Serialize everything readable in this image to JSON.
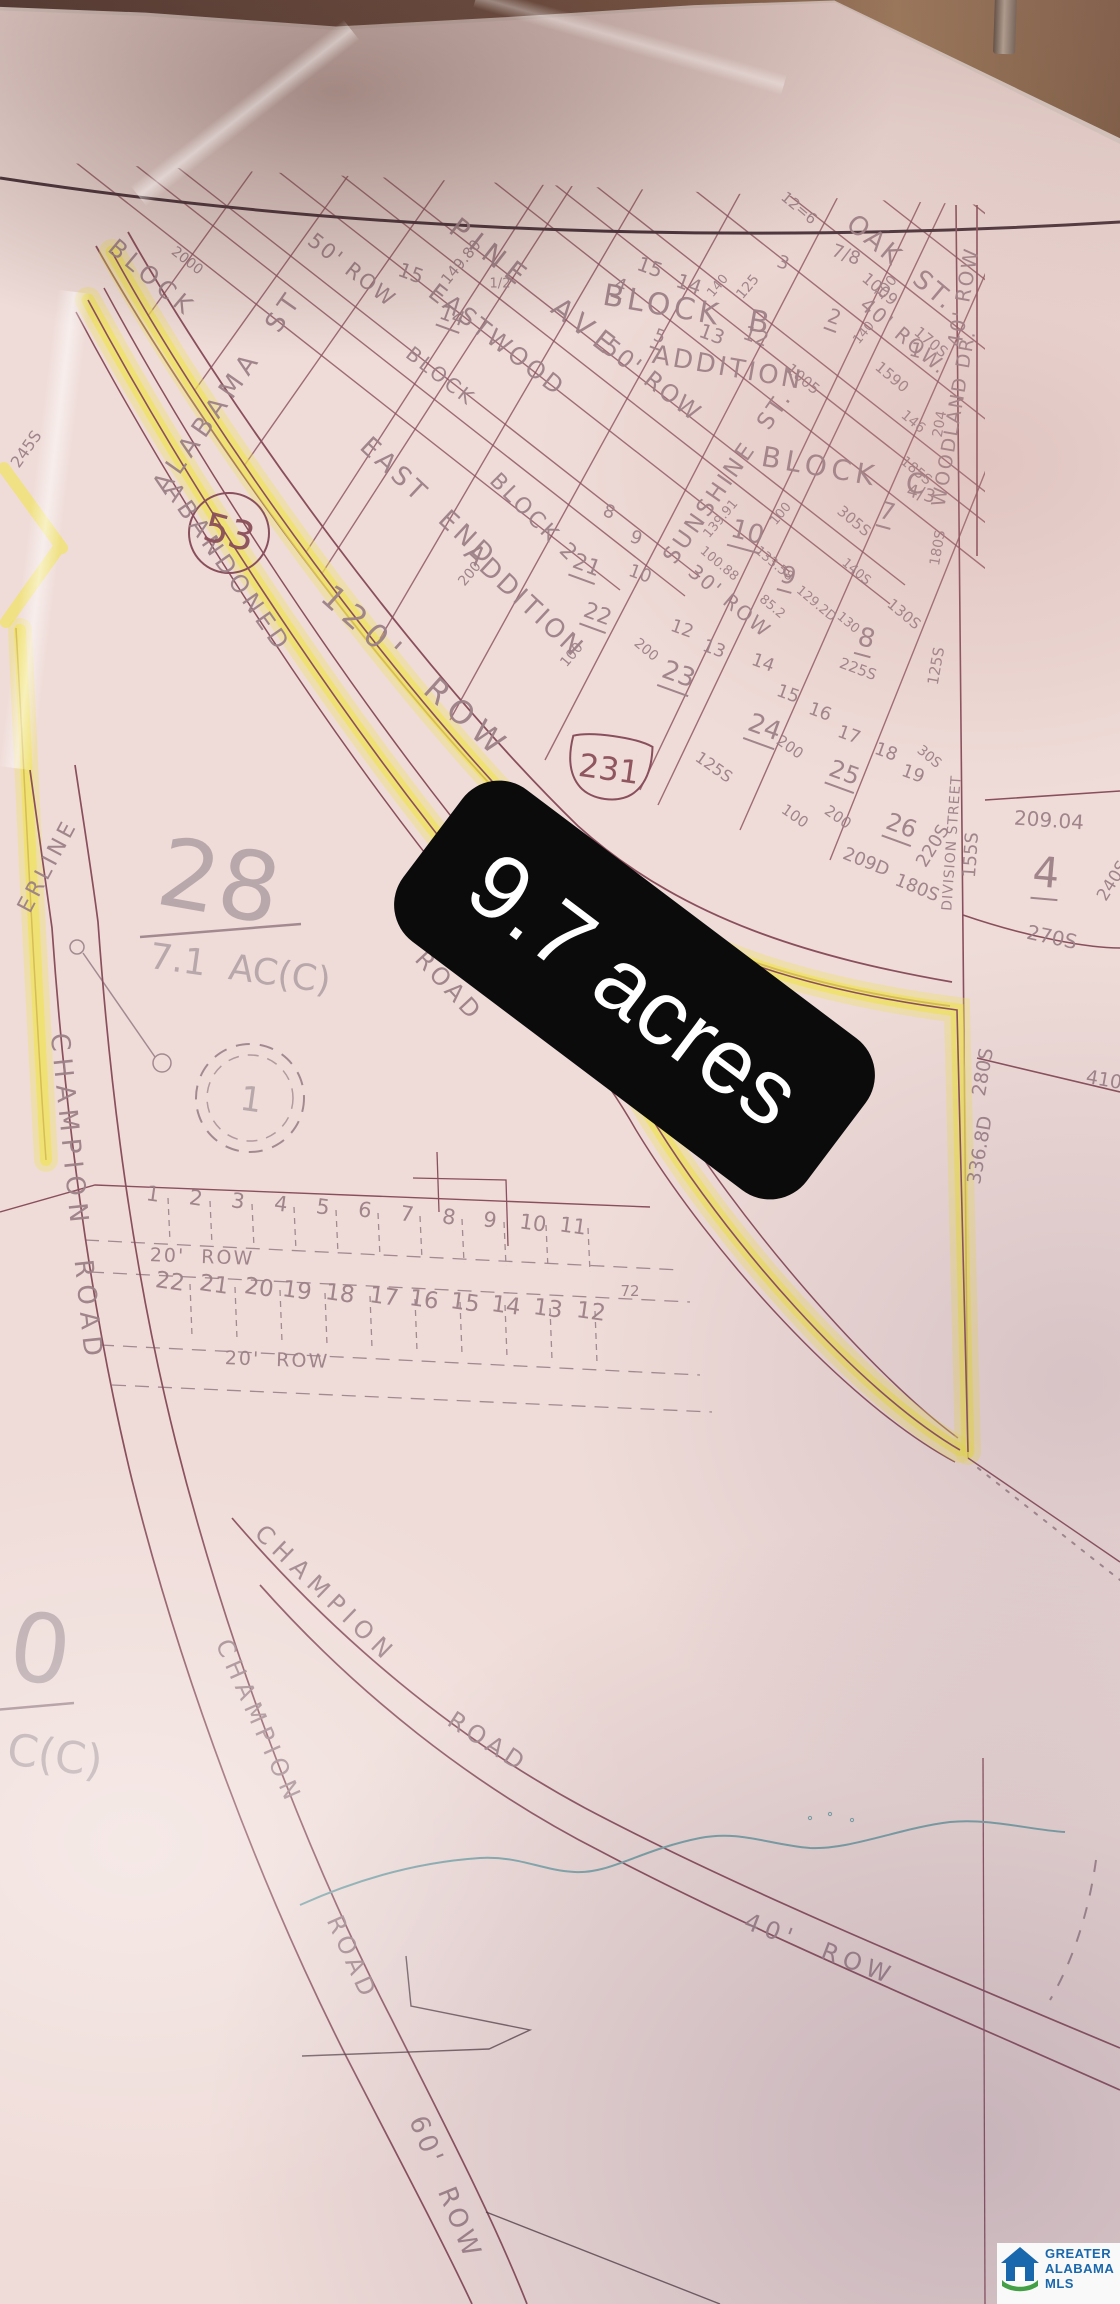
{
  "photo": {
    "acres_label": "9.7 acres"
  },
  "watermark": {
    "line1": "GREATER",
    "line2": "ALABAMA",
    "line3": "MLS"
  },
  "colors": {
    "highlight": "#f0e353",
    "label_bg": "#0b0b0b",
    "label_text": "#ffffff",
    "logo_blue": "#1967ad",
    "logo_green": "#43a047",
    "ink": "#8a4f5c",
    "ink_dark": "#46313a",
    "pencil": "#a38a90",
    "stream": "#7aa4a8"
  },
  "map": {
    "route_shields": [
      {
        "type": "circle",
        "number": "53"
      },
      {
        "type": "us-shield",
        "number": "231"
      }
    ],
    "labels": [
      {
        "t": "BLOCK",
        "x": 152,
        "y": 278,
        "r": 40,
        "s": 24,
        "ls": 5
      },
      {
        "t": "PINE  AVE",
        "x": 535,
        "y": 288,
        "r": 38,
        "s": 28,
        "ls": 8
      },
      {
        "t": "ALABAMA  ST",
        "x": 228,
        "y": 392,
        "r": -55,
        "s": 26,
        "ls": 6
      },
      {
        "t": "50' ROW",
        "x": 352,
        "y": 270,
        "r": 38,
        "s": 21,
        "ls": 2
      },
      {
        "t": "EASTWOOD",
        "x": 497,
        "y": 340,
        "r": 38,
        "s": 24,
        "ls": 3
      },
      {
        "t": "BLOCK",
        "x": 441,
        "y": 376,
        "r": 38,
        "s": 20,
        "ls": 3
      },
      {
        "t": "BLOCK  B",
        "x": 688,
        "y": 310,
        "r": 10,
        "s": 30,
        "ls": 4
      },
      {
        "t": "ADDITION",
        "x": 728,
        "y": 368,
        "r": 10,
        "s": 26,
        "ls": 3
      },
      {
        "t": "50' ROW",
        "x": 652,
        "y": 380,
        "r": 38,
        "s": 24,
        "ls": 2
      },
      {
        "t": "OAK  ST.",
        "x": 901,
        "y": 263,
        "r": 40,
        "s": 26,
        "ls": 3
      },
      {
        "t": "40' ROW.",
        "x": 904,
        "y": 336,
        "r": 40,
        "s": 20,
        "ls": 2
      },
      {
        "t": "40' ROW",
        "x": 963,
        "y": 297,
        "r": -80,
        "s": 20,
        "ls": 2
      },
      {
        "t": "WOODLAND DR.",
        "x": 954,
        "y": 418,
        "r": -80,
        "s": 19,
        "ls": 2
      },
      {
        "t": "SUNSHINE  ST.",
        "x": 728,
        "y": 477,
        "r": -55,
        "s": 23,
        "ls": 3
      },
      {
        "t": "BLOCK  C",
        "x": 846,
        "y": 471,
        "r": 10,
        "s": 28,
        "ls": 5
      },
      {
        "t": "EAST  END",
        "x": 428,
        "y": 502,
        "r": 43,
        "s": 26,
        "ls": 4
      },
      {
        "t": "ADDITION",
        "x": 524,
        "y": 601,
        "r": 43,
        "s": 26,
        "ls": 3
      },
      {
        "t": "BLOCK 2",
        "x": 534,
        "y": 518,
        "r": 45,
        "s": 22,
        "ls": 3
      },
      {
        "t": "ABANDONED",
        "x": 228,
        "y": 568,
        "r": 55,
        "s": 24,
        "ls": 5
      },
      {
        "t": "ROAD",
        "x": 449,
        "y": 986,
        "r": 47,
        "s": 24,
        "ls": 4
      },
      {
        "t": "120'  ROW",
        "x": 416,
        "y": 672,
        "r": 42,
        "s": 32,
        "ls": 8
      },
      {
        "t": "DIVISION STREET",
        "x": 952,
        "y": 843,
        "r": -86,
        "s": 14,
        "ls": 1
      },
      {
        "t": "CHAMPION  ROAD",
        "x": 76,
        "y": 1198,
        "r": 84,
        "s": 26,
        "ls": 7
      },
      {
        "t": "CHAMPION",
        "x": 326,
        "y": 1594,
        "r": 44,
        "s": 24,
        "ls": 7
      },
      {
        "t": "ROAD",
        "x": 488,
        "y": 1742,
        "r": 33,
        "s": 24,
        "ls": 5
      },
      {
        "t": "CHAMPION",
        "x": 259,
        "y": 1722,
        "r": 66,
        "s": 24,
        "ls": 6
      },
      {
        "t": "ROAD",
        "x": 352,
        "y": 1958,
        "r": 66,
        "s": 24,
        "ls": 5
      },
      {
        "t": "60'  ROW",
        "x": 445,
        "y": 2188,
        "r": 68,
        "s": 26,
        "ls": 4
      },
      {
        "t": "40'  ROW",
        "x": 820,
        "y": 1949,
        "r": 21,
        "s": 24,
        "ls": 6
      },
      {
        "t": "ERLINE",
        "x": 48,
        "y": 866,
        "r": -62,
        "s": 22,
        "ls": 4
      },
      {
        "t": "28",
        "x": 219,
        "y": 882,
        "r": 10,
        "s": 95,
        "c": "f"
      },
      {
        "t": "7.1  AC(C)",
        "x": 240,
        "y": 969,
        "r": 8,
        "s": 36,
        "c": "f"
      },
      {
        "t": "0",
        "x": 40,
        "y": 1650,
        "r": 8,
        "s": 95,
        "c": "f"
      },
      {
        "t": "C(C)",
        "x": 55,
        "y": 1756,
        "r": 8,
        "s": 44,
        "c": "f"
      },
      {
        "t": "1",
        "x": 251,
        "y": 1100,
        "r": 8,
        "s": 34,
        "c": "f"
      },
      {
        "t": "4",
        "x": 1046,
        "y": 874,
        "r": 5,
        "s": 42,
        "u": 1
      },
      {
        "t": "53",
        "x": 229,
        "y": 533,
        "r": 15,
        "s": 40,
        "c": "m"
      },
      {
        "t": "231",
        "x": 609,
        "y": 769,
        "r": 8,
        "s": 32,
        "c": "m"
      },
      {
        "t": "15",
        "x": 411,
        "y": 273,
        "r": 20,
        "s": 20
      },
      {
        "t": "14",
        "x": 452,
        "y": 317,
        "r": 20,
        "s": 20,
        "u": 1
      },
      {
        "t": "149.80",
        "x": 461,
        "y": 262,
        "r": -50,
        "s": 15
      },
      {
        "t": "2000",
        "x": 187,
        "y": 261,
        "r": 38,
        "s": 14
      },
      {
        "t": "15",
        "x": 650,
        "y": 267,
        "r": 20,
        "s": 20
      },
      {
        "t": "14",
        "x": 689,
        "y": 284,
        "r": 20,
        "s": 20
      },
      {
        "t": "13",
        "x": 712,
        "y": 334,
        "r": 20,
        "s": 20
      },
      {
        "t": "12",
        "x": 756,
        "y": 336,
        "r": 20,
        "s": 20
      },
      {
        "t": "4",
        "x": 620,
        "y": 287,
        "r": 20,
        "s": 18,
        "u": 1
      },
      {
        "t": "5",
        "x": 659,
        "y": 338,
        "r": 20,
        "s": 18,
        "u": 1
      },
      {
        "t": "3",
        "x": 783,
        "y": 263,
        "r": 20,
        "s": 18
      },
      {
        "t": "2",
        "x": 834,
        "y": 318,
        "r": 20,
        "s": 20,
        "u": 1
      },
      {
        "t": "7/8",
        "x": 846,
        "y": 255,
        "r": 20,
        "s": 18
      },
      {
        "t": "1009",
        "x": 880,
        "y": 289,
        "r": 40,
        "s": 16
      },
      {
        "t": "1005",
        "x": 803,
        "y": 379,
        "r": 40,
        "s": 15
      },
      {
        "t": "125",
        "x": 748,
        "y": 287,
        "r": -50,
        "s": 14
      },
      {
        "t": "140",
        "x": 718,
        "y": 286,
        "r": -50,
        "s": 13
      },
      {
        "t": "100",
        "x": 886,
        "y": 288,
        "r": -50,
        "s": 14
      },
      {
        "t": "140",
        "x": 864,
        "y": 333,
        "r": -50,
        "s": 13
      },
      {
        "t": "12=6",
        "x": 799,
        "y": 208,
        "r": 40,
        "s": 15
      },
      {
        "t": "1/2",
        "x": 500,
        "y": 284,
        "r": 0,
        "s": 13
      },
      {
        "t": "8",
        "x": 609,
        "y": 512,
        "r": 20,
        "s": 18
      },
      {
        "t": "9",
        "x": 636,
        "y": 538,
        "r": 20,
        "s": 18
      },
      {
        "t": "10",
        "x": 640,
        "y": 574,
        "r": 20,
        "s": 18
      },
      {
        "t": "21",
        "x": 586,
        "y": 567,
        "r": 20,
        "s": 22,
        "u": 1
      },
      {
        "t": "22",
        "x": 597,
        "y": 616,
        "r": 20,
        "s": 22,
        "u": 1
      },
      {
        "t": "23",
        "x": 678,
        "y": 676,
        "r": 20,
        "s": 26,
        "u": 1
      },
      {
        "t": "24",
        "x": 764,
        "y": 729,
        "r": 20,
        "s": 26,
        "u": 1
      },
      {
        "t": "25",
        "x": 844,
        "y": 774,
        "r": 20,
        "s": 24,
        "u": 1
      },
      {
        "t": "26",
        "x": 901,
        "y": 827,
        "r": 20,
        "s": 24,
        "u": 1
      },
      {
        "t": "12",
        "x": 682,
        "y": 629,
        "r": 20,
        "s": 18
      },
      {
        "t": "13",
        "x": 714,
        "y": 649,
        "r": 20,
        "s": 18
      },
      {
        "t": "14",
        "x": 763,
        "y": 663,
        "r": 20,
        "s": 18
      },
      {
        "t": "15",
        "x": 788,
        "y": 694,
        "r": 20,
        "s": 18
      },
      {
        "t": "16",
        "x": 820,
        "y": 712,
        "r": 20,
        "s": 18
      },
      {
        "t": "17",
        "x": 849,
        "y": 735,
        "r": 20,
        "s": 18
      },
      {
        "t": "18",
        "x": 886,
        "y": 752,
        "r": 20,
        "s": 18
      },
      {
        "t": "19",
        "x": 913,
        "y": 774,
        "r": 20,
        "s": 18
      },
      {
        "t": "10",
        "x": 747,
        "y": 534,
        "r": 15,
        "s": 26,
        "u": 1
      },
      {
        "t": "9",
        "x": 788,
        "y": 577,
        "r": 15,
        "s": 24,
        "u": 1
      },
      {
        "t": "8",
        "x": 866,
        "y": 640,
        "r": 15,
        "s": 26,
        "u": 1
      },
      {
        "t": "7",
        "x": 887,
        "y": 513,
        "r": 15,
        "s": 24,
        "u": 1
      },
      {
        "t": "4/3",
        "x": 921,
        "y": 494,
        "r": 15,
        "s": 18
      },
      {
        "t": "1",
        "x": 916,
        "y": 350,
        "r": 15,
        "s": 20
      },
      {
        "t": "1590",
        "x": 892,
        "y": 377,
        "r": 40,
        "s": 15
      },
      {
        "t": "170S",
        "x": 931,
        "y": 342,
        "r": 40,
        "s": 15
      },
      {
        "t": "146",
        "x": 913,
        "y": 422,
        "r": 40,
        "s": 14
      },
      {
        "t": "204",
        "x": 940,
        "y": 424,
        "r": -80,
        "s": 14
      },
      {
        "t": "185S",
        "x": 916,
        "y": 471,
        "r": 40,
        "s": 14
      },
      {
        "t": "305S",
        "x": 854,
        "y": 521,
        "r": 40,
        "s": 15
      },
      {
        "t": "139.91",
        "x": 721,
        "y": 519,
        "r": -50,
        "s": 13
      },
      {
        "t": "100",
        "x": 781,
        "y": 514,
        "r": -50,
        "s": 13
      },
      {
        "t": "133.58",
        "x": 774,
        "y": 564,
        "r": 40,
        "s": 13
      },
      {
        "t": "100.88",
        "x": 719,
        "y": 564,
        "r": 40,
        "s": 13
      },
      {
        "t": "85.2",
        "x": 772,
        "y": 607,
        "r": 40,
        "s": 13
      },
      {
        "t": "129.2D",
        "x": 816,
        "y": 604,
        "r": 40,
        "s": 13
      },
      {
        "t": "130",
        "x": 848,
        "y": 623,
        "r": 40,
        "s": 13
      },
      {
        "t": "140S",
        "x": 856,
        "y": 572,
        "r": 40,
        "s": 13
      },
      {
        "t": "130S",
        "x": 904,
        "y": 614,
        "r": 40,
        "s": 15
      },
      {
        "t": "225S",
        "x": 858,
        "y": 669,
        "r": 20,
        "s": 15
      },
      {
        "t": "125S",
        "x": 936,
        "y": 666,
        "r": -80,
        "s": 15
      },
      {
        "t": "180S",
        "x": 938,
        "y": 548,
        "r": -80,
        "s": 14
      },
      {
        "t": "200",
        "x": 646,
        "y": 650,
        "r": 40,
        "s": 14
      },
      {
        "t": "100",
        "x": 572,
        "y": 655,
        "r": -50,
        "s": 14
      },
      {
        "t": "200",
        "x": 470,
        "y": 574,
        "r": -50,
        "s": 14
      },
      {
        "t": "30' ROW",
        "x": 730,
        "y": 601,
        "r": 40,
        "s": 20,
        "ls": 2
      },
      {
        "t": "30S",
        "x": 929,
        "y": 757,
        "r": 40,
        "s": 14
      },
      {
        "t": "100",
        "x": 795,
        "y": 816,
        "r": 35,
        "s": 15
      },
      {
        "t": "200",
        "x": 838,
        "y": 817,
        "r": 35,
        "s": 15
      },
      {
        "t": "200",
        "x": 790,
        "y": 747,
        "r": 35,
        "s": 15
      },
      {
        "t": "125S",
        "x": 714,
        "y": 767,
        "r": 35,
        "s": 16
      },
      {
        "t": "155S",
        "x": 971,
        "y": 855,
        "r": -86,
        "s": 18
      },
      {
        "t": "220S",
        "x": 933,
        "y": 846,
        "r": -58,
        "s": 18
      },
      {
        "t": "209.04",
        "x": 1049,
        "y": 820,
        "r": 4,
        "s": 20
      },
      {
        "t": "240S",
        "x": 1113,
        "y": 881,
        "r": -58,
        "s": 17
      },
      {
        "t": "270S",
        "x": 1052,
        "y": 937,
        "r": 12,
        "s": 20
      },
      {
        "t": "209D",
        "x": 866,
        "y": 862,
        "r": 22,
        "s": 18
      },
      {
        "t": "180S",
        "x": 917,
        "y": 888,
        "r": 22,
        "s": 18
      },
      {
        "t": "280S",
        "x": 983,
        "y": 1072,
        "r": -80,
        "s": 19
      },
      {
        "t": "336.8D",
        "x": 980,
        "y": 1150,
        "r": -80,
        "s": 19
      },
      {
        "t": "410",
        "x": 1104,
        "y": 1080,
        "r": 10,
        "s": 19
      },
      {
        "t": "245S",
        "x": 26,
        "y": 449,
        "r": -55,
        "s": 16
      },
      {
        "t": "72",
        "x": 630,
        "y": 1291,
        "r": 0,
        "s": 15
      },
      {
        "t": "1",
        "x": 153,
        "y": 1194,
        "r": 8,
        "s": 21
      },
      {
        "t": "2",
        "x": 196,
        "y": 1198,
        "r": 8,
        "s": 21
      },
      {
        "t": "3",
        "x": 238,
        "y": 1201,
        "r": 8,
        "s": 21
      },
      {
        "t": "4",
        "x": 281,
        "y": 1204,
        "r": 8,
        "s": 21
      },
      {
        "t": "5",
        "x": 323,
        "y": 1207,
        "r": 8,
        "s": 21
      },
      {
        "t": "6",
        "x": 365,
        "y": 1210,
        "r": 8,
        "s": 21
      },
      {
        "t": "7",
        "x": 407,
        "y": 1214,
        "r": 8,
        "s": 21
      },
      {
        "t": "8",
        "x": 449,
        "y": 1217,
        "r": 8,
        "s": 21
      },
      {
        "t": "9",
        "x": 490,
        "y": 1220,
        "r": 8,
        "s": 21
      },
      {
        "t": "10",
        "x": 533,
        "y": 1223,
        "r": 8,
        "s": 21
      },
      {
        "t": "11",
        "x": 573,
        "y": 1226,
        "r": 8,
        "s": 21
      },
      {
        "t": "20'  ROW",
        "x": 202,
        "y": 1257,
        "r": 2,
        "s": 19,
        "ls": 2
      },
      {
        "t": "20'  ROW",
        "x": 277,
        "y": 1360,
        "r": 2,
        "s": 19,
        "ls": 2
      },
      {
        "t": "22",
        "x": 170,
        "y": 1282,
        "r": 8,
        "s": 23
      },
      {
        "t": "21",
        "x": 214,
        "y": 1285,
        "r": 8,
        "s": 23
      },
      {
        "t": "20",
        "x": 259,
        "y": 1288,
        "r": 8,
        "s": 23
      },
      {
        "t": "19",
        "x": 297,
        "y": 1291,
        "r": 8,
        "s": 23
      },
      {
        "t": "18",
        "x": 340,
        "y": 1294,
        "r": 8,
        "s": 23
      },
      {
        "t": "17",
        "x": 384,
        "y": 1297,
        "r": 8,
        "s": 23
      },
      {
        "t": "16",
        "x": 424,
        "y": 1300,
        "r": 8,
        "s": 23
      },
      {
        "t": "15",
        "x": 465,
        "y": 1303,
        "r": 8,
        "s": 23
      },
      {
        "t": "14",
        "x": 506,
        "y": 1306,
        "r": 8,
        "s": 23
      },
      {
        "t": "13",
        "x": 548,
        "y": 1309,
        "r": 8,
        "s": 23
      },
      {
        "t": "12",
        "x": 591,
        "y": 1312,
        "r": 8,
        "s": 23
      }
    ]
  }
}
